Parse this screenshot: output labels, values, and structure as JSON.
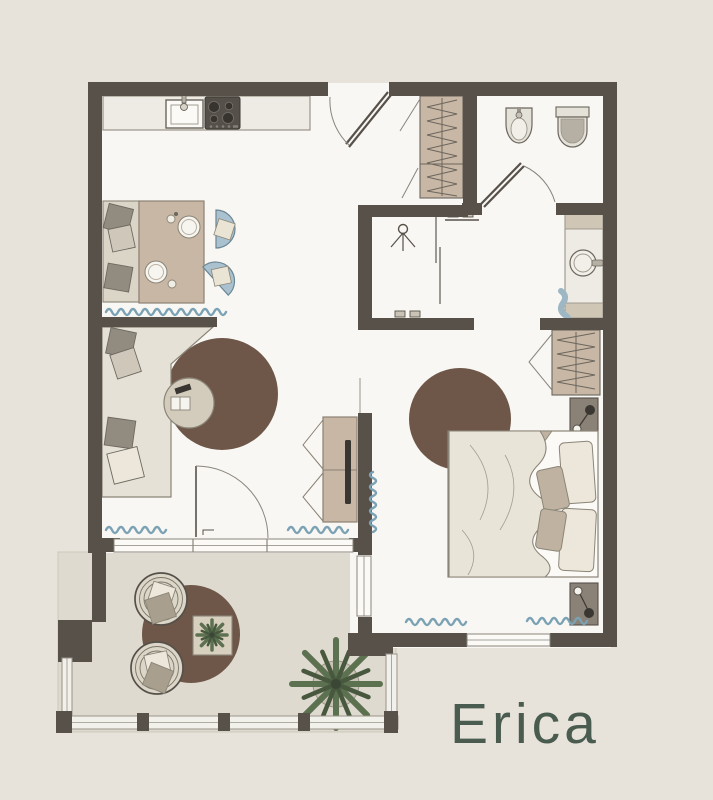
{
  "title": "Erica",
  "palette": {
    "background": "#e7e3da",
    "floor": "#f8f7f3",
    "balcony_floor": "#dfdacf",
    "wall": "#57514a",
    "outline": "#6b665e",
    "wood": "#c8b7a4",
    "wood_outline": "#8b8174",
    "marble": "#edebe4",
    "sofa_beige": "#e5e1d6",
    "bench_beige": "#dbd5c8",
    "chair_blue": "#aac2cf",
    "chair_blue_outline": "#6b8695",
    "radiator_blue": "#7ba2b4",
    "towel_blue": "#9db7c4",
    "rug_brown": "#6e5749",
    "bed_linen": "#e9e4d8",
    "pillow_cream": "#ece7da",
    "pillow_gray": "#928b80",
    "pillow_taupe": "#bfb2a0",
    "nightstand": "#8a8177",
    "appliance_dark": "#55514a",
    "wicker": "#dcd6c8",
    "plant_green": "#5c7150",
    "plant_dark": "#47583f",
    "railing_light": "#f2f0ea",
    "title_green": "#4a5c50"
  }
}
